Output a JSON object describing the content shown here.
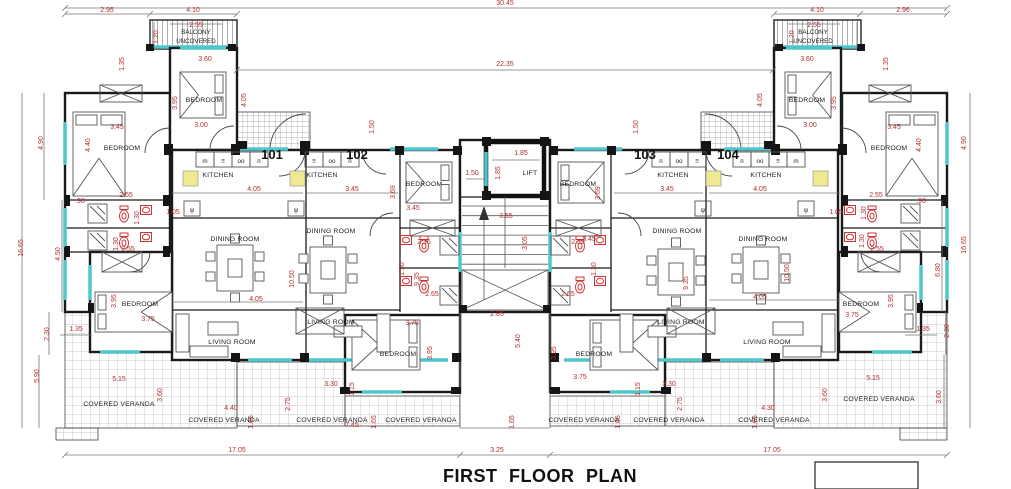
{
  "title": "FIRST FLOOR PLAN",
  "colors": {
    "dimension_text": "#b03030",
    "walls": "#1a1a1a",
    "window_teal": "#4fc6cc",
    "sink_yellow": "#efe98f",
    "fixture_red": "#cc3333",
    "hatch": "#b9b9b9"
  },
  "unit_labels": [
    {
      "t": "101",
      "x": 272,
      "y": 159
    },
    {
      "t": "102",
      "x": 357,
      "y": 159
    },
    {
      "t": "103",
      "x": 645,
      "y": 159
    },
    {
      "t": "104",
      "x": 728,
      "y": 159
    }
  ],
  "balcony_labels": [
    {
      "t": "BALCONY",
      "x": 196,
      "y": 34
    },
    {
      "t": "UNCOVERED",
      "x": 196,
      "y": 43
    },
    {
      "t": "BALCONY",
      "x": 813,
      "y": 34
    },
    {
      "t": "UNCOVERED",
      "x": 813,
      "y": 43
    }
  ],
  "room_labels": [
    {
      "t": "KITCHEN",
      "x": 218,
      "y": 177
    },
    {
      "t": "KITCHEN",
      "x": 322,
      "y": 177
    },
    {
      "t": "KITCHEN",
      "x": 673,
      "y": 177
    },
    {
      "t": "KITCHEN",
      "x": 766,
      "y": 177
    },
    {
      "t": "DINING ROOM",
      "x": 235,
      "y": 241
    },
    {
      "t": "DINING ROOM",
      "x": 331,
      "y": 233
    },
    {
      "t": "DINING ROOM",
      "x": 677,
      "y": 233
    },
    {
      "t": "DINING ROOM",
      "x": 763,
      "y": 241
    },
    {
      "t": "LIVING ROOM",
      "x": 232,
      "y": 344
    },
    {
      "t": "LIVING ROOM",
      "x": 331,
      "y": 324
    },
    {
      "t": "LIVING ROOM",
      "x": 681,
      "y": 324
    },
    {
      "t": "LIVING ROOM",
      "x": 767,
      "y": 344
    },
    {
      "t": "BEDROOM",
      "x": 204,
      "y": 102
    },
    {
      "t": "BEDROOM",
      "x": 122,
      "y": 150
    },
    {
      "t": "BEDROOM",
      "x": 140,
      "y": 306
    },
    {
      "t": "BEDROOM",
      "x": 424,
      "y": 186
    },
    {
      "t": "BEDROOM",
      "x": 398,
      "y": 356
    },
    {
      "t": "BEDROOM",
      "x": 578,
      "y": 186
    },
    {
      "t": "BEDROOM",
      "x": 594,
      "y": 356
    },
    {
      "t": "BEDROOM",
      "x": 807,
      "y": 102
    },
    {
      "t": "BEDROOM",
      "x": 889,
      "y": 150
    },
    {
      "t": "BEDROOM",
      "x": 861,
      "y": 306
    },
    {
      "t": "COVERED VERANDA",
      "x": 119,
      "y": 406
    },
    {
      "t": "COVERED VERANDA",
      "x": 224,
      "y": 422
    },
    {
      "t": "COVERED VERANDA",
      "x": 332,
      "y": 422
    },
    {
      "t": "COVERED VERANDA",
      "x": 421,
      "y": 422
    },
    {
      "t": "COVERED VERANDA",
      "x": 584,
      "y": 422
    },
    {
      "t": "COVERED VERANDA",
      "x": 669,
      "y": 422
    },
    {
      "t": "COVERED VERANDA",
      "x": 774,
      "y": 422
    },
    {
      "t": "COVERED VERANDA",
      "x": 879,
      "y": 401
    },
    {
      "t": "LIFT",
      "x": 530,
      "y": 175
    }
  ],
  "fixture_glyphs": [
    {
      "t": "m",
      "x": 205,
      "y": 163
    },
    {
      "t": "≡",
      "x": 223,
      "y": 163
    },
    {
      "t": "oo",
      "x": 241,
      "y": 163
    },
    {
      "t": "п",
      "x": 259,
      "y": 163
    },
    {
      "t": "≡",
      "x": 314,
      "y": 163
    },
    {
      "t": "oo",
      "x": 332,
      "y": 163
    },
    {
      "t": "п",
      "x": 350,
      "y": 163
    },
    {
      "t": "п",
      "x": 661,
      "y": 163
    },
    {
      "t": "oo",
      "x": 679,
      "y": 163
    },
    {
      "t": "≡",
      "x": 697,
      "y": 163
    },
    {
      "t": "п",
      "x": 742,
      "y": 163
    },
    {
      "t": "oo",
      "x": 760,
      "y": 163
    },
    {
      "t": "≡",
      "x": 778,
      "y": 163
    },
    {
      "t": "m",
      "x": 796,
      "y": 163
    },
    {
      "t": "ψ",
      "x": 192,
      "y": 212
    },
    {
      "t": "ψ",
      "x": 296,
      "y": 212
    },
    {
      "t": "ψ",
      "x": 703,
      "y": 212
    },
    {
      "t": "ψ",
      "x": 806,
      "y": 212
    }
  ],
  "dimensions": [
    {
      "t": "30.45",
      "x": 505,
      "y": 5
    },
    {
      "t": "2.95",
      "x": 107,
      "y": 12
    },
    {
      "t": "4.10",
      "x": 193,
      "y": 12
    },
    {
      "t": "2.55",
      "x": 196,
      "y": 27
    },
    {
      "t": "1.20",
      "x": 158,
      "y": 37,
      "v": 1
    },
    {
      "t": "4.10",
      "x": 817,
      "y": 12
    },
    {
      "t": "2.96",
      "x": 903,
      "y": 12
    },
    {
      "t": "2.55",
      "x": 814,
      "y": 27
    },
    {
      "t": "1.20",
      "x": 794,
      "y": 37,
      "v": 1
    },
    {
      "t": "22.35",
      "x": 505,
      "y": 66
    },
    {
      "t": "3.60",
      "x": 205,
      "y": 61
    },
    {
      "t": "1.35",
      "x": 124,
      "y": 64,
      "v": 1
    },
    {
      "t": "3.95",
      "x": 177,
      "y": 103,
      "v": 1
    },
    {
      "t": "3.00",
      "x": 201,
      "y": 127
    },
    {
      "t": "4.05",
      "x": 246,
      "y": 100,
      "v": 1
    },
    {
      "t": "3.45",
      "x": 117,
      "y": 129
    },
    {
      "t": "4.40",
      "x": 90,
      "y": 145,
      "v": 1
    },
    {
      "t": "4.90",
      "x": 43,
      "y": 143,
      "v": 1
    },
    {
      "t": "3.60",
      "x": 807,
      "y": 61
    },
    {
      "t": "1.35",
      "x": 888,
      "y": 64,
      "v": 1
    },
    {
      "t": "3.95",
      "x": 836,
      "y": 103,
      "v": 1
    },
    {
      "t": "3.00",
      "x": 810,
      "y": 127
    },
    {
      "t": "4.05",
      "x": 762,
      "y": 100,
      "v": 1
    },
    {
      "t": "3.45",
      "x": 894,
      "y": 129
    },
    {
      "t": "4.40",
      "x": 921,
      "y": 145,
      "v": 1
    },
    {
      "t": "4.90",
      "x": 966,
      "y": 143,
      "v": 1
    },
    {
      "t": "1.50",
      "x": 374,
      "y": 127,
      "v": 1
    },
    {
      "t": "1.50",
      "x": 638,
      "y": 127,
      "v": 1
    },
    {
      "t": "1.85",
      "x": 521,
      "y": 155
    },
    {
      "t": "1.85",
      "x": 500,
      "y": 173,
      "v": 1
    },
    {
      "t": "1.50",
      "x": 472,
      "y": 175
    },
    {
      "t": "3.55",
      "x": 506,
      "y": 218
    },
    {
      "t": "3.05",
      "x": 527,
      "y": 243,
      "v": 1
    },
    {
      "t": "4.05",
      "x": 254,
      "y": 191
    },
    {
      "t": "3.45",
      "x": 352,
      "y": 191
    },
    {
      "t": "3.45",
      "x": 667,
      "y": 191
    },
    {
      "t": "4.05",
      "x": 760,
      "y": 191
    },
    {
      "t": "1.05",
      "x": 173,
      "y": 214
    },
    {
      "t": "1.05",
      "x": 836,
      "y": 214
    },
    {
      "t": ".90",
      "x": 80,
      "y": 203
    },
    {
      "t": ".90",
      "x": 921,
      "y": 203
    },
    {
      "t": "2.55",
      "x": 126,
      "y": 197
    },
    {
      "t": "2.55",
      "x": 128,
      "y": 251
    },
    {
      "t": "1.30",
      "x": 139,
      "y": 218,
      "v": 1
    },
    {
      "t": "1.30",
      "x": 118,
      "y": 244,
      "v": 1
    },
    {
      "t": "2.55",
      "x": 876,
      "y": 197
    },
    {
      "t": "2.55",
      "x": 877,
      "y": 251
    },
    {
      "t": "1.30",
      "x": 866,
      "y": 213,
      "v": 1
    },
    {
      "t": "1.30",
      "x": 864,
      "y": 241,
      "v": 1
    },
    {
      "t": "16.65",
      "x": 23,
      "y": 248,
      "v": 1
    },
    {
      "t": "4.50",
      "x": 60,
      "y": 254,
      "v": 1
    },
    {
      "t": "16.65",
      "x": 966,
      "y": 245,
      "v": 1
    },
    {
      "t": "6.80",
      "x": 940,
      "y": 270,
      "v": 1
    },
    {
      "t": "10.50",
      "x": 294,
      "y": 279,
      "v": 1
    },
    {
      "t": "9.35",
      "x": 419,
      "y": 279,
      "v": 1
    },
    {
      "t": "9.35",
      "x": 688,
      "y": 283,
      "v": 1
    },
    {
      "t": "10.50",
      "x": 789,
      "y": 273,
      "v": 1
    },
    {
      "t": "4.05",
      "x": 256,
      "y": 301
    },
    {
      "t": "4.05",
      "x": 760,
      "y": 299
    },
    {
      "t": "3.69",
      "x": 395,
      "y": 192,
      "v": 1
    },
    {
      "t": "3.69",
      "x": 600,
      "y": 193,
      "v": 1
    },
    {
      "t": "3.45",
      "x": 413,
      "y": 210
    },
    {
      "t": "3.45",
      "x": 589,
      "y": 241
    },
    {
      "t": "2.35",
      "x": 424,
      "y": 244
    },
    {
      "t": "2.35",
      "x": 578,
      "y": 244
    },
    {
      "t": "1.30",
      "x": 404,
      "y": 269,
      "v": 1
    },
    {
      "t": "1.30",
      "x": 596,
      "y": 269,
      "v": 1
    },
    {
      "t": "2.65",
      "x": 432,
      "y": 296
    },
    {
      "t": "2.65",
      "x": 568,
      "y": 296
    },
    {
      "t": "2.85",
      "x": 497,
      "y": 316
    },
    {
      "t": "5.40",
      "x": 520,
      "y": 341,
      "v": 1
    },
    {
      "t": "3.95",
      "x": 432,
      "y": 353,
      "v": 1
    },
    {
      "t": "3.95",
      "x": 556,
      "y": 353,
      "v": 1
    },
    {
      "t": "3.75",
      "x": 412,
      "y": 325
    },
    {
      "t": "3.75",
      "x": 580,
      "y": 379
    },
    {
      "t": "3.95",
      "x": 116,
      "y": 301,
      "v": 1
    },
    {
      "t": "3.75",
      "x": 148,
      "y": 321
    },
    {
      "t": "3.95",
      "x": 893,
      "y": 301,
      "v": 1
    },
    {
      "t": "3.75",
      "x": 852,
      "y": 317
    },
    {
      "t": "2.30",
      "x": 49,
      "y": 334,
      "v": 1
    },
    {
      "t": "1.35",
      "x": 76,
      "y": 331
    },
    {
      "t": "5.90",
      "x": 39,
      "y": 376,
      "v": 1
    },
    {
      "t": "2.30",
      "x": 949,
      "y": 331,
      "v": 1
    },
    {
      "t": "1.35",
      "x": 923,
      "y": 331
    },
    {
      "t": "3.60",
      "x": 941,
      "y": 397,
      "v": 1
    },
    {
      "t": "5.15",
      "x": 119,
      "y": 381
    },
    {
      "t": "3.60",
      "x": 162,
      "y": 395,
      "v": 1
    },
    {
      "t": "5.15",
      "x": 873,
      "y": 380
    },
    {
      "t": "3.60",
      "x": 827,
      "y": 395,
      "v": 1
    },
    {
      "t": "4.40",
      "x": 231,
      "y": 410
    },
    {
      "t": "4.30",
      "x": 768,
      "y": 410
    },
    {
      "t": "3.30",
      "x": 331,
      "y": 386
    },
    {
      "t": "3.30",
      "x": 669,
      "y": 386
    },
    {
      "t": "1.15",
      "x": 354,
      "y": 389,
      "v": 1
    },
    {
      "t": "1.15",
      "x": 640,
      "y": 389,
      "v": 1
    },
    {
      "t": "2.75",
      "x": 290,
      "y": 404,
      "v": 1
    },
    {
      "t": "2.75",
      "x": 682,
      "y": 404,
      "v": 1
    },
    {
      "t": "7.45",
      "x": 352,
      "y": 427
    },
    {
      "t": "1.65",
      "x": 253,
      "y": 422,
      "v": 1
    },
    {
      "t": "1.65",
      "x": 376,
      "y": 422,
      "v": 1
    },
    {
      "t": "1.65",
      "x": 514,
      "y": 422,
      "v": 1
    },
    {
      "t": "1.65",
      "x": 620,
      "y": 422,
      "v": 1
    },
    {
      "t": "1.65",
      "x": 757,
      "y": 422,
      "v": 1
    },
    {
      "t": "17.05",
      "x": 237,
      "y": 452
    },
    {
      "t": "3.25",
      "x": 497,
      "y": 452
    },
    {
      "t": "17.05",
      "x": 772,
      "y": 452
    }
  ]
}
